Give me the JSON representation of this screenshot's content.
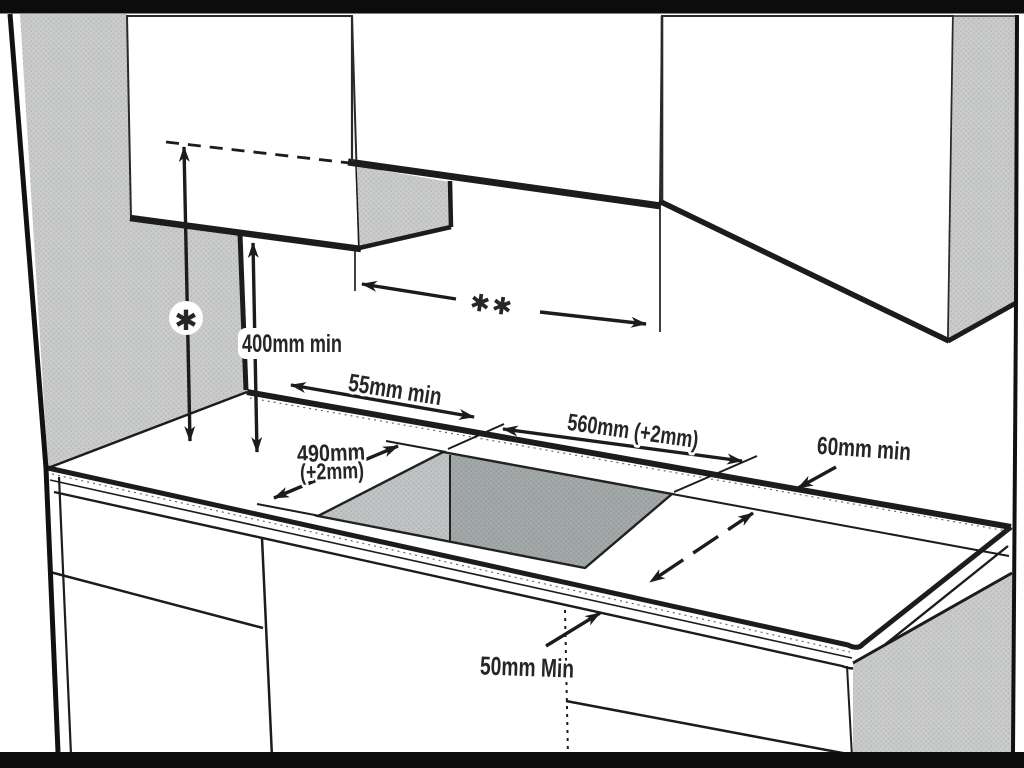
{
  "figure": {
    "description": "Hob installation clearance diagram (scanned manual page)",
    "annotations": {
      "hood_height_symbol": "✱",
      "hood_width_symbol": "✱✱",
      "cabinet_height_min": "400mm min",
      "rear_clearance_min": "55mm min",
      "cutout_width": "560mm (+2mm)",
      "cutout_depth": "490mm",
      "cutout_depth_tolerance": "(+2mm)",
      "side_clearance_min": "60mm min",
      "front_clearance_min": "50mm Min"
    },
    "colors": {
      "line": "#1c1c1c",
      "frame_bar": "#0c0c0c",
      "cabinet_gray": "#cacbcb",
      "cutout_wall_gray": "#bfc3c3",
      "cutout_bottom_gray": "#a3a8a8",
      "background": "#ffffff"
    }
  }
}
